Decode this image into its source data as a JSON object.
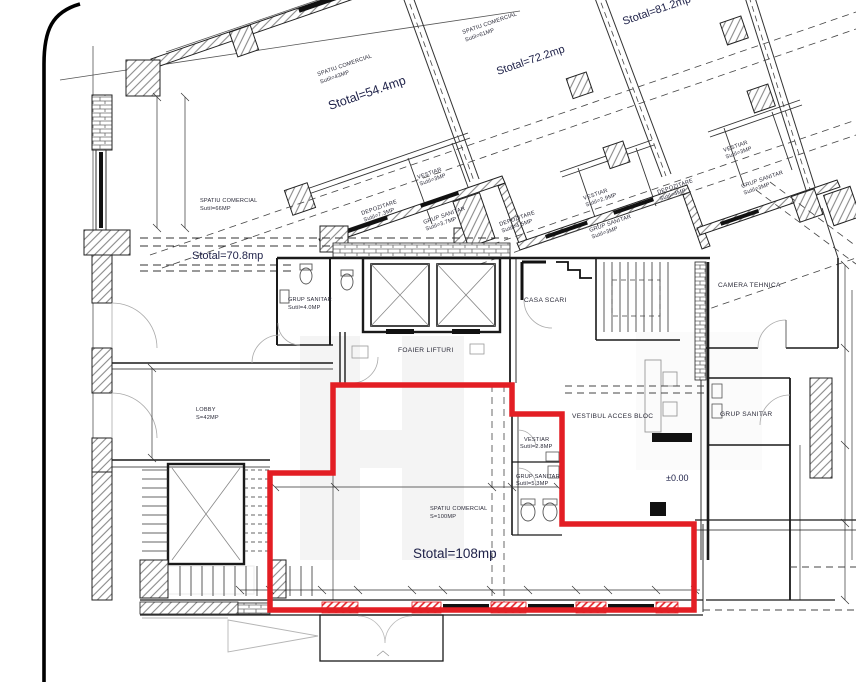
{
  "document": {
    "type": "architectural floor plan (ground floor, retail spaces)",
    "highlight_note": "red outline marks commercial space Stotal=108mp"
  },
  "colors": {
    "highlight_red": "#e31e24",
    "ink": "#1f1f1f",
    "label_navy": "#20234a",
    "hatch_gray": "#777777",
    "watermark_gray": "#d4d4d4"
  },
  "plan": {
    "commercial_spaces": {
      "s54": {
        "name": "SPATIU COMERCIAL",
        "util": "Sutil=43MP",
        "total": "Stotal=54.4mp"
      },
      "s72": {
        "name": "SPATIU COMERCIAL",
        "util": "Sutil=61MP",
        "total": "Stotal=72.2mp"
      },
      "s81": {
        "total": "Stotal=81.2mp"
      },
      "s70": {
        "name": "SPATIU COMERCIAL",
        "util": "Sutil=66MP",
        "total": "Stotal=70.8mp"
      },
      "s108": {
        "name": "SPATIU COMERCIAL",
        "util": "S=100MP",
        "total": "Stotal=108mp"
      }
    },
    "service_rooms": {
      "cluster1": {
        "dep1": {
          "name": "DEPOZITARE",
          "util": "Sutil=7.3MP"
        },
        "vest": {
          "name": "VESTIAR",
          "util": "Sutil=3MP"
        },
        "gs": {
          "name": "GRUP SANITAR",
          "util": "Sutil=3.7MP"
        },
        "dep2": {
          "name": "DEPOZITARE",
          "util": "Sutil=4.5MP"
        }
      },
      "cluster2": {
        "vest": {
          "name": "VESTIAR",
          "util": "Sutil=2.9MP"
        },
        "gs": {
          "name": "GRUP SANITAR",
          "util": "Sutil=3MP"
        },
        "dep": {
          "name": "DEPOZITARE",
          "util": "Sutil=4MP"
        }
      },
      "cluster3": {
        "vest": {
          "name": "VESTIAR",
          "util": "Sutil=3MP"
        },
        "gs": {
          "name": "GRUP SANITAR",
          "util": "Sutil=3MP"
        }
      },
      "gs40": {
        "name": "GRUP SANITAR",
        "util": "Sutil=4.0MP"
      },
      "vest28": {
        "name": "VESTIAR",
        "util": "Sutil=2.8MP"
      },
      "gs53": {
        "name": "GRUP SANITAR",
        "util": "Sutil=5.3MP"
      },
      "gs_right": {
        "name": "GRUP SANITAR"
      }
    },
    "circulation": {
      "lobby": {
        "name": "LOBBY",
        "util": "S=42MP"
      },
      "foaier": {
        "name": "FOAIER LIFTURI"
      },
      "casa_scari": {
        "name": "CASA SCARI"
      },
      "camera_tehnica": {
        "name": "CAMERA TEHNICA"
      },
      "vestibul": {
        "name": "VESTIBUL ACCES BLOC"
      }
    },
    "annotations": {
      "level": "±0.00"
    }
  }
}
